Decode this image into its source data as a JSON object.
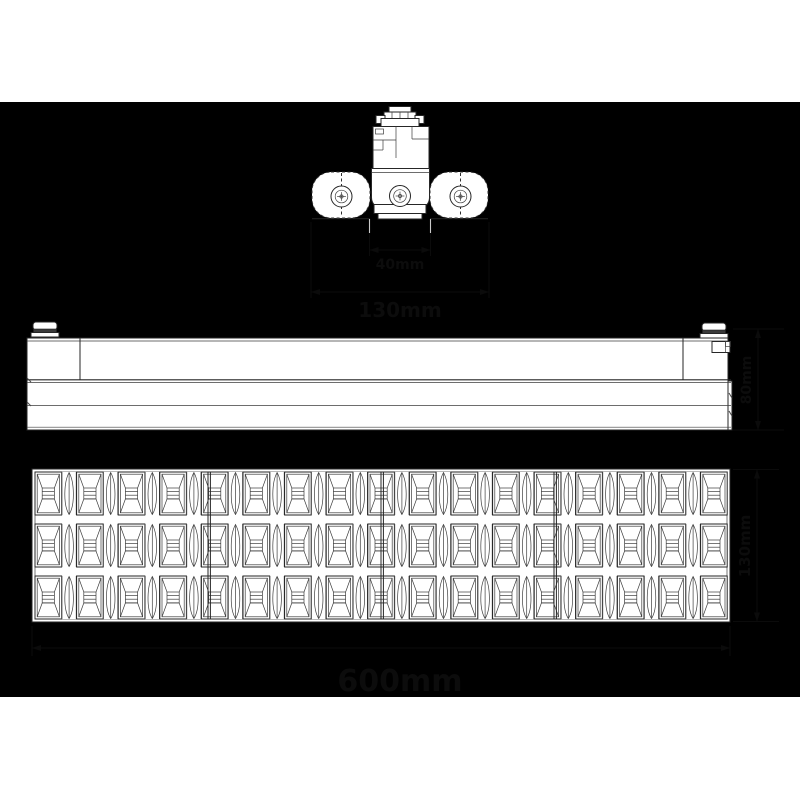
{
  "page": {
    "background_color": "#ffffff",
    "panel_color": "#000000",
    "line_color": "#262626",
    "artwork_fill": "#ffffff",
    "hidden_ink_color": "#0b0b0b"
  },
  "drawing": {
    "subject": "linear track light fixture dimension drawing",
    "views": {
      "end_view": {
        "name": "end view with track adapter",
        "screw_count": 3
      },
      "side_view": {
        "name": "side elevation with two twist-lock knobs"
      },
      "bottom_view": {
        "name": "bottom louver view",
        "grid": {
          "rows": 3,
          "squares_per_row": 17,
          "leaves_per_row": 16,
          "modules": 4
        }
      }
    },
    "dimensions": [
      {
        "id": "lens-width",
        "label": "40mm",
        "orientation": "horizontal"
      },
      {
        "id": "body-width",
        "label": "130mm",
        "orientation": "horizontal"
      },
      {
        "id": "fixture-height",
        "label": "80mm",
        "orientation": "vertical"
      },
      {
        "id": "fixture-depth",
        "label": "130mm",
        "orientation": "vertical"
      },
      {
        "id": "fixture-length",
        "label": "600mm",
        "orientation": "horizontal"
      }
    ]
  }
}
